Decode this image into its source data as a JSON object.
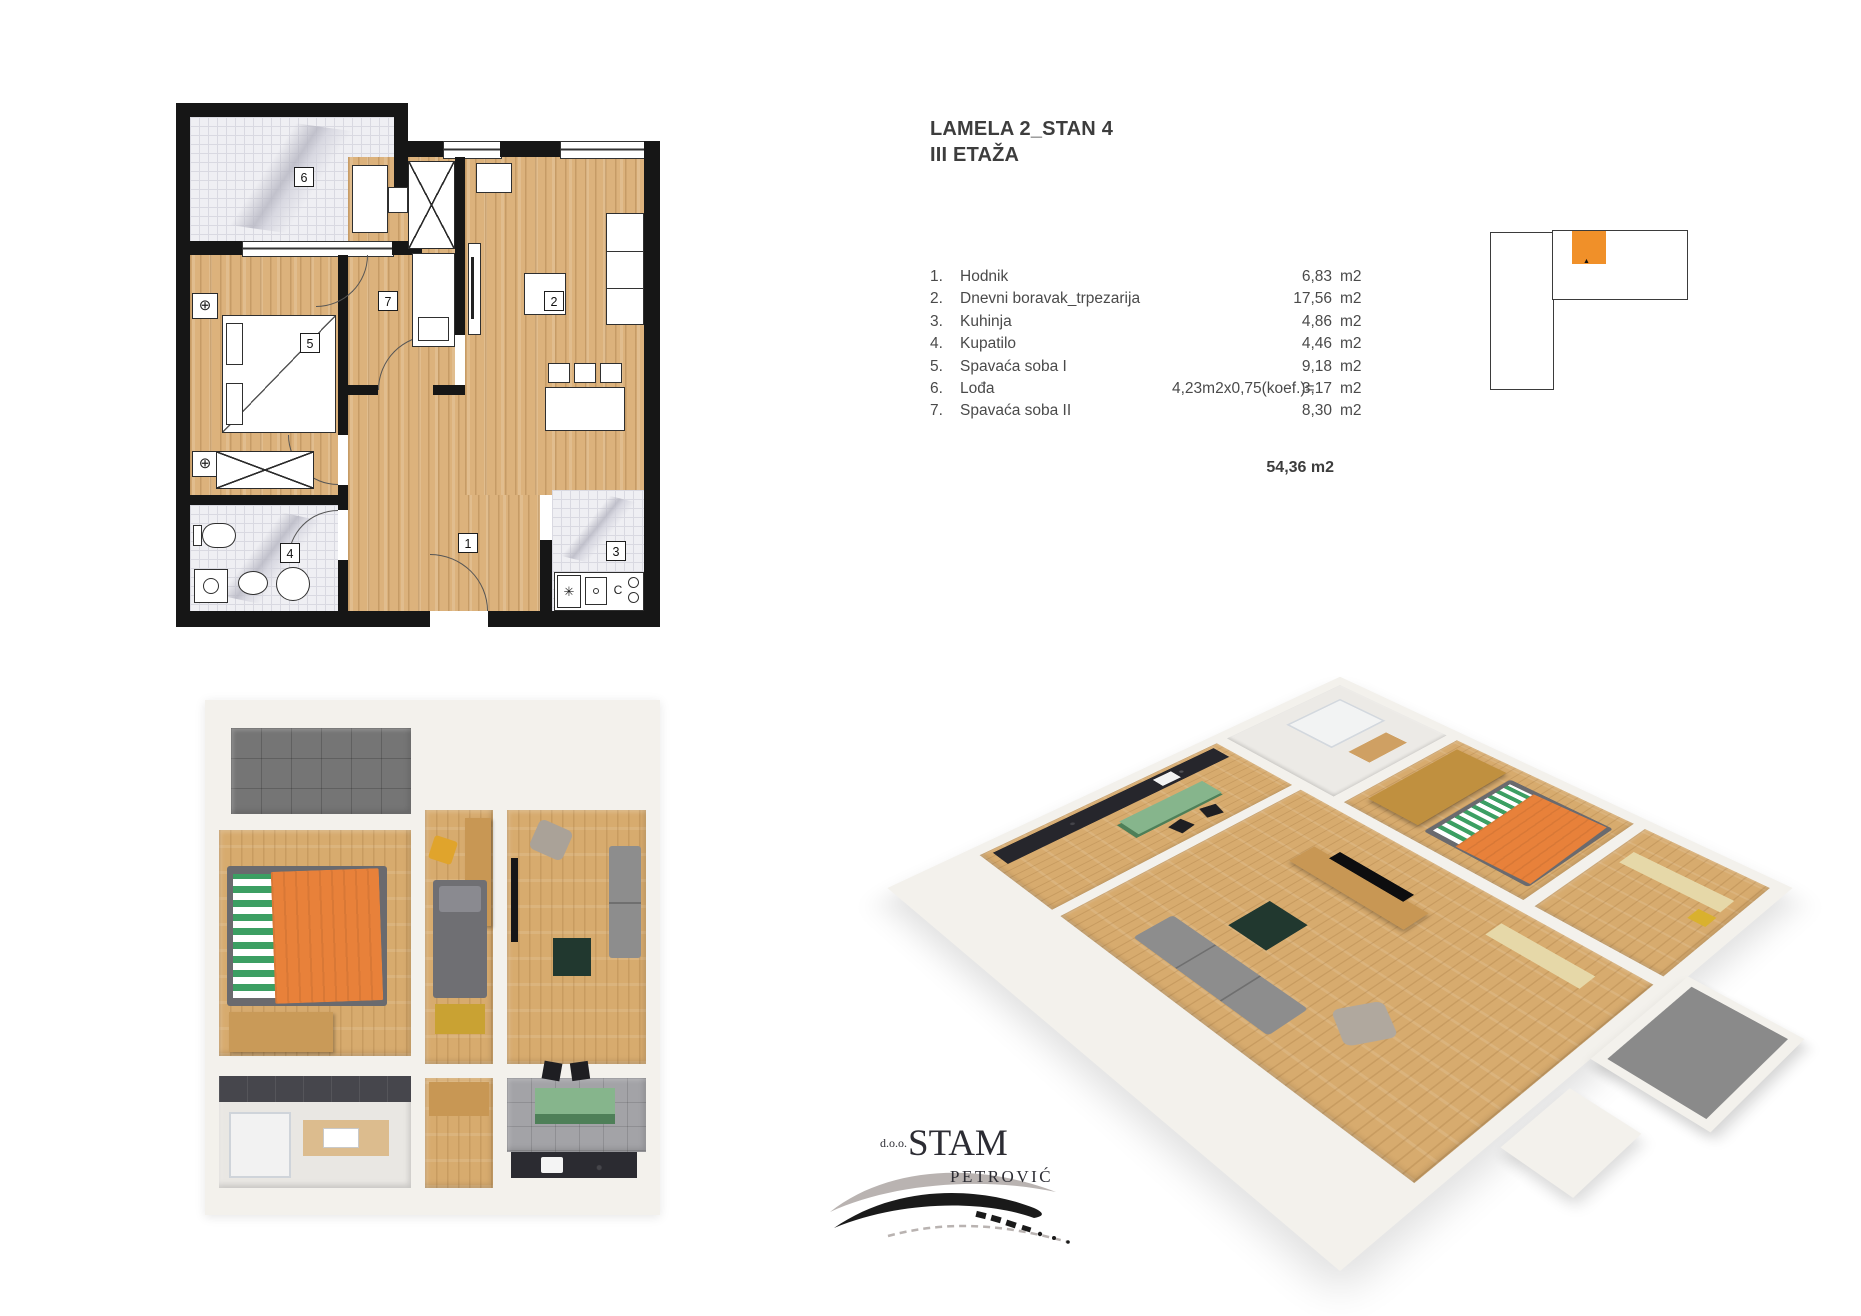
{
  "info": {
    "title_line1": "LAMELA 2_STAN 4",
    "title_line2": "III ETAŽA",
    "rooms": [
      {
        "no": "1.",
        "name": "Hodnik",
        "koef": "",
        "area": "6,83",
        "unit": "m2"
      },
      {
        "no": "2.",
        "name": "Dnevni boravak_trpezarija",
        "koef": "",
        "area": "17,56",
        "unit": "m2"
      },
      {
        "no": "3.",
        "name": "Kuhinja",
        "koef": "",
        "area": "4,86",
        "unit": "m2"
      },
      {
        "no": "4.",
        "name": "Kupatilo",
        "koef": "",
        "area": "4,46",
        "unit": "m2"
      },
      {
        "no": "5.",
        "name": "Spavaća soba I",
        "koef": "",
        "area": "9,18",
        "unit": "m2"
      },
      {
        "no": "6.",
        "name": "Lođa",
        "koef": "4,23m2x0,75(koef.)=",
        "area": "3,17",
        "unit": "m2"
      },
      {
        "no": "7.",
        "name": "Spavaća soba II",
        "koef": "",
        "area": "8,30",
        "unit": "m2"
      }
    ],
    "total": "54,36 m2"
  },
  "plan2d": {
    "room_numbers": {
      "hall": "1",
      "living": "2",
      "kitchen": "3",
      "bath": "4",
      "bedroom1": "5",
      "loggia": "6",
      "bedroom2": "7"
    },
    "stove_label": "C"
  },
  "icons": {
    "radiator": "⊕",
    "freezer": "✳",
    "unit_marker": "▲"
  },
  "key_plan": {
    "highlight_color": "#f09029",
    "outline_color": "#3b3b3b"
  },
  "logo": {
    "prefix": "d.o.o.",
    "name": "STAM",
    "surname": "PETROVIĆ"
  },
  "colors": {
    "wall": "#161616",
    "wood": "#dcb27c",
    "tile": "#efeff3",
    "render_wall": "#f3f1ec",
    "render_wood": "#d7ab6e",
    "loggia_gray": "#757575",
    "bed_orange": "#e8813a",
    "bed_green": "#3c9f63",
    "sofa_gray": "#8d8d8d",
    "island_green": "#86b58c",
    "counter_dark": "#2b2b31",
    "chair_yellow": "#e0a42c",
    "table_darkgreen": "#21382f"
  }
}
